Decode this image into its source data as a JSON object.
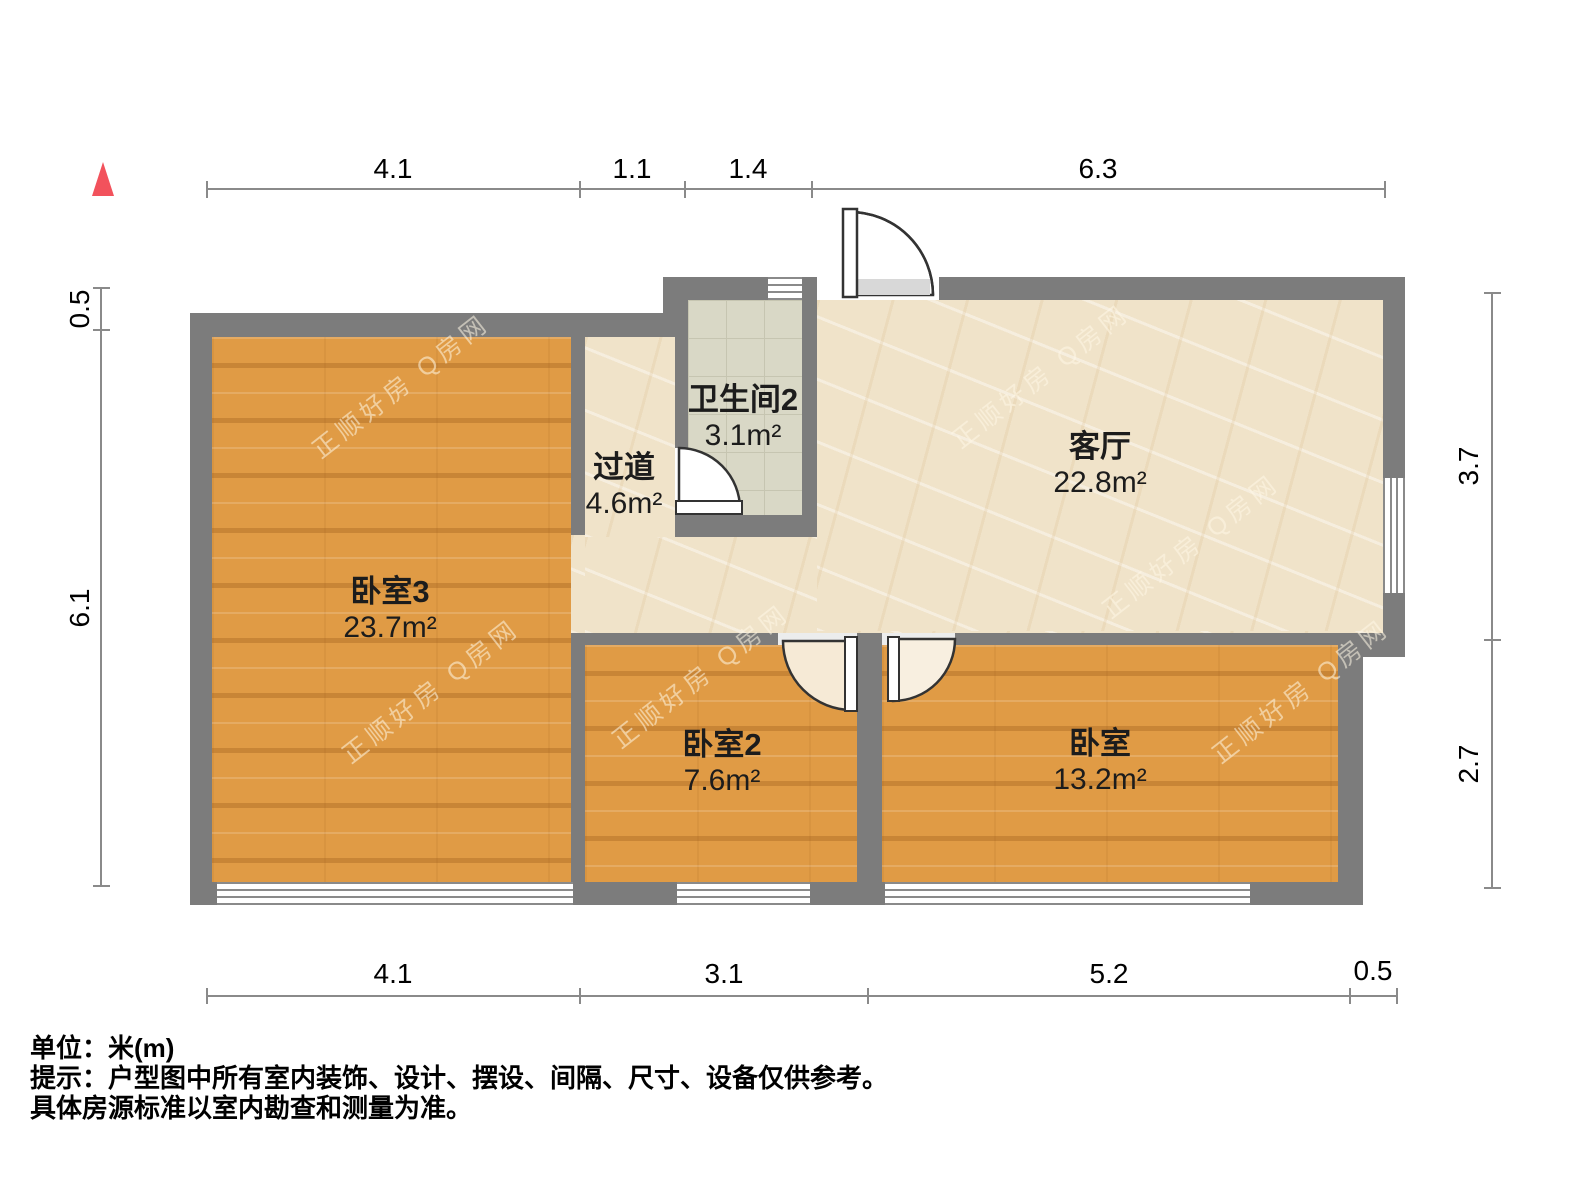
{
  "rooms": [
    {
      "name": "卧室3",
      "area": "23.7m²"
    },
    {
      "name": "过道",
      "area": "4.6m²"
    },
    {
      "name": "卫生间2",
      "area": "3.1m²"
    },
    {
      "name": "客厅",
      "area": "22.8m²"
    },
    {
      "name": "卧室2",
      "area": "7.6m²"
    },
    {
      "name": "卧室",
      "area": "13.2m²"
    }
  ],
  "dimensions": {
    "top": [
      "4.1",
      "1.1",
      "1.4",
      "6.3"
    ],
    "bottom": [
      "4.1",
      "3.1",
      "5.2",
      "0.5"
    ],
    "left": [
      "0.5",
      "6.1"
    ],
    "right": [
      "3.7",
      "2.7"
    ]
  },
  "notes": {
    "unit": "单位：米(m)",
    "tip_line1": "提示：户型图中所有室内装饰、设计、摆设、间隔、尺寸、设备仅供参考。",
    "tip_line2": "具体房源标准以室内勘查和测量为准。"
  },
  "watermark": {
    "text": "正顺好房 Q房网"
  },
  "colors": {
    "wall": "#7c7c7c",
    "wood_floor": "#e09b45",
    "marble_floor": "#f0e3c9",
    "tile_floor": "#d9d8c6",
    "north_marker": "#f2525c",
    "dimension_line": "#8a8a8a"
  }
}
